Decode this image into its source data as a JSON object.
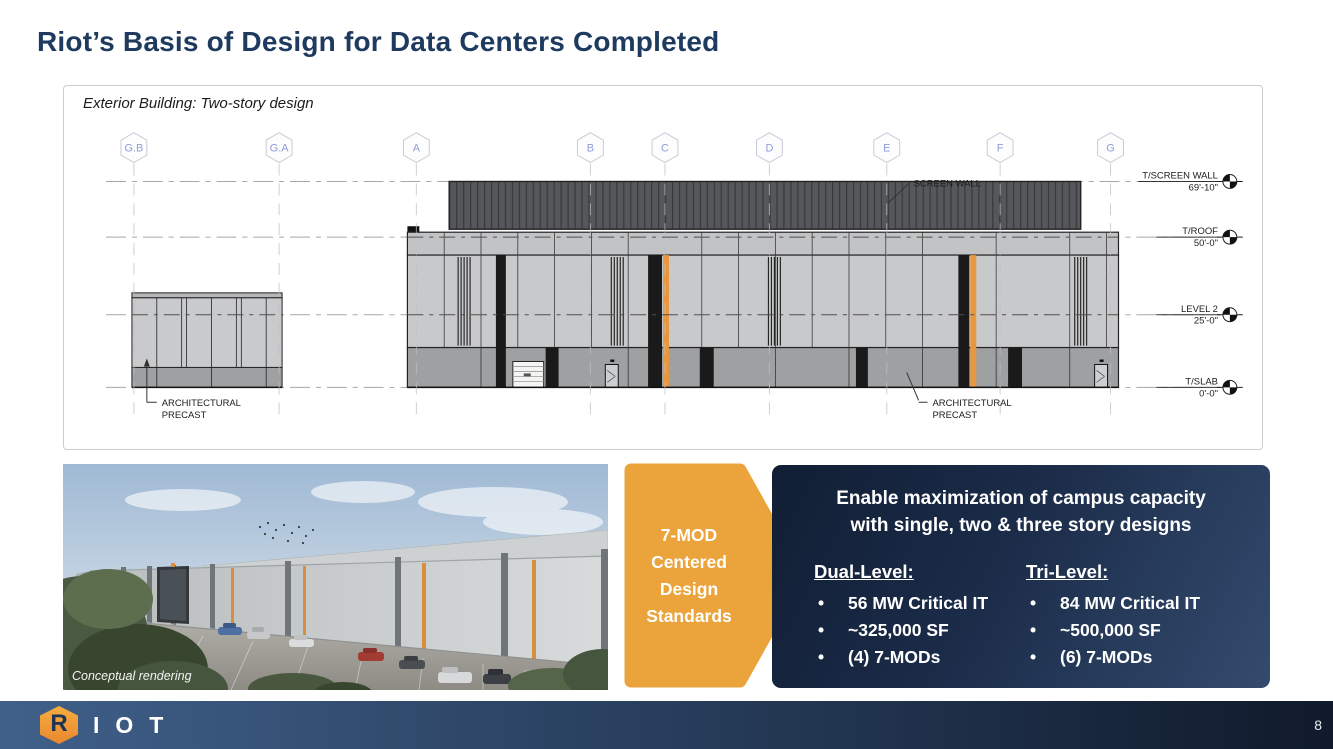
{
  "slide": {
    "title": "Riot’s Basis of Design for Data Centers Completed",
    "page_number": "8"
  },
  "drawing": {
    "caption": "Exterior Building: Two-story design",
    "grid_labels": [
      "G.B",
      "G.A",
      "A",
      "B",
      "C",
      "D",
      "E",
      "F",
      "G"
    ],
    "labels": {
      "screen_wall": "SCREEN WALL",
      "precast_line1": "ARCHITECTURAL",
      "precast_line2": "PRECAST"
    },
    "elevation_marks": [
      {
        "name": "T/SCREEN WALL",
        "value": "69'-10\""
      },
      {
        "name": "T/ROOF",
        "value": "50'-0\""
      },
      {
        "name": "LEVEL 2",
        "value": "25'-0\""
      },
      {
        "name": "T/SLAB",
        "value": "0'-0\""
      }
    ]
  },
  "photo": {
    "caption": "Conceptual rendering"
  },
  "chevron": {
    "lines": [
      "7-MOD",
      "Centered",
      "Design",
      "Standards"
    ],
    "color": "#EBA33C"
  },
  "info_box": {
    "heading_line1": "Enable maximization of campus capacity",
    "heading_line2": "with single, two & three story designs",
    "columns": [
      {
        "heading": "Dual-Level:",
        "bullets": [
          "56 MW Critical IT",
          "~325,000 SF",
          "(4) 7-MODs"
        ]
      },
      {
        "heading": "Tri-Level:",
        "bullets": [
          "84 MW Critical IT",
          "~500,000 SF",
          "(6) 7-MODs"
        ]
      }
    ]
  },
  "footer": {
    "hex_letter": "R",
    "wordmark": "IOT",
    "page_number": "8"
  },
  "colors": {
    "title_navy": "#1E3A5F",
    "accent_orange": "#EBA33C",
    "stripe_orange": "#E9973C",
    "box_gradient_start": "#111E34",
    "box_gradient_end": "#344B6E",
    "footer_gradient_start": "#40608A",
    "footer_gradient_end": "#101A2B"
  }
}
